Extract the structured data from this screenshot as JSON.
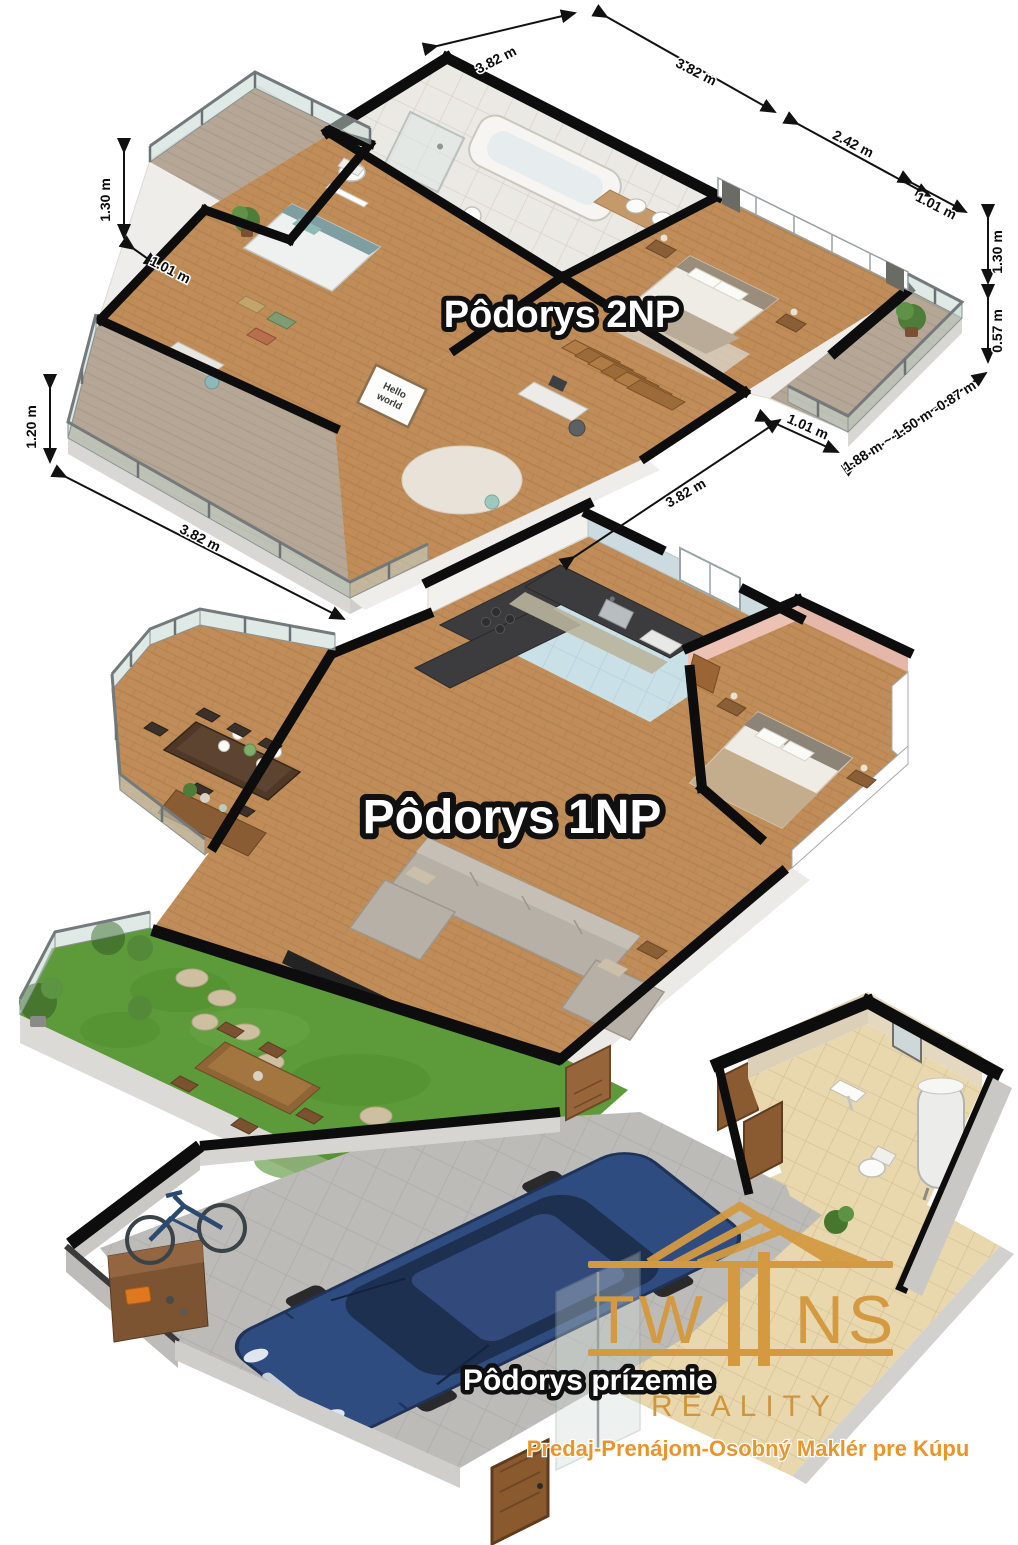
{
  "floors": {
    "second": {
      "title": "Pôdorys 2NP"
    },
    "first": {
      "title": "Pôdorys 1NP"
    },
    "ground": {
      "title": "Pôdorys prízemie"
    }
  },
  "dimensions": {
    "items": [
      {
        "id": "top-left",
        "label": "3.82 m"
      },
      {
        "id": "top-right",
        "label": "3.82 m"
      },
      {
        "id": "right-upper",
        "label": "2.42 m"
      },
      {
        "id": "right-small",
        "label": "1.01 m"
      },
      {
        "id": "right-v1",
        "label": "1.30 m"
      },
      {
        "id": "right-v2",
        "label": "0.57 m"
      },
      {
        "id": "right-chain",
        "label": "1.88 m ~ 1.50 m -0.87 m"
      },
      {
        "id": "bottom-small",
        "label": "1.01 m"
      },
      {
        "id": "bottom-se",
        "label": "3.82 m"
      },
      {
        "id": "left-v1",
        "label": "1.30 m"
      },
      {
        "id": "left-small",
        "label": "1.01 m"
      },
      {
        "id": "left-v2",
        "label": "1.20 m"
      },
      {
        "id": "bottom-left",
        "label": "3.82 m"
      }
    ]
  },
  "poster": {
    "line1": "Hello",
    "line2": "world"
  },
  "logo": {
    "brand": "TWIINS",
    "part_left": "TW",
    "part_right": "NS",
    "subtitle": "REALITY",
    "tagline": "Predaj-Prenájom-Osobný Maklér pre Kúpu"
  },
  "colors": {
    "logo_gold": "#d39a42",
    "tagline_orange": "#e8952b",
    "wall_black": "#0d0d0d",
    "wood_floor": "#c08d58",
    "terrace_floor": "#b5a695",
    "kitchen_floor": "#cae0e7",
    "bedroom_wall_pink": "#ecc2b4",
    "grass_green": "#5c9a3a",
    "car_blue": "#2e4c80",
    "tile_beige": "#e9d7ae"
  }
}
